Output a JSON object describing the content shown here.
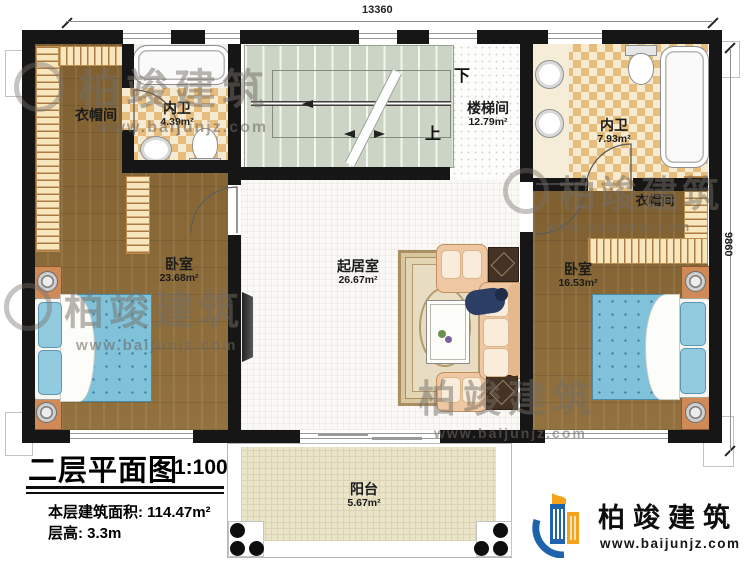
{
  "dimensions": {
    "width": "13360",
    "height": "9860"
  },
  "rooms": {
    "cloakroom_left": {
      "name": "衣帽间"
    },
    "bath_left": {
      "name": "内卫",
      "area": "4.39m²"
    },
    "stairwell": {
      "name": "楼梯间",
      "area": "12.79m²"
    },
    "bath_right": {
      "name": "内卫",
      "area": "7.93m²"
    },
    "cloakroom_right": {
      "name": "衣帽间"
    },
    "bedroom_left": {
      "name": "卧室",
      "area": "23.68m²"
    },
    "living_room": {
      "name": "起居室",
      "area": "26.67m²"
    },
    "bedroom_right": {
      "name": "卧室",
      "area": "16.53m²"
    },
    "balcony": {
      "name": "阳台",
      "area": "5.67m²"
    }
  },
  "stairs": {
    "down_label": "下",
    "up_label": "上"
  },
  "title_block": {
    "title": "二层平面图",
    "scale": "1:100",
    "floor_area_label": "本层建筑面积:",
    "floor_area_value": "114.47m²",
    "floor_height_label": "层高:",
    "floor_height_value": "3.3m"
  },
  "brand": {
    "name": "柏竣建筑",
    "website": "www.baijunjz.com"
  },
  "watermark": {
    "text": "柏竣建筑",
    "website": "www.baijunjz.com"
  },
  "colors": {
    "brand_blue": "#1e63ab",
    "brand_orange": "#f5a21c",
    "wall_black": "#161616"
  }
}
